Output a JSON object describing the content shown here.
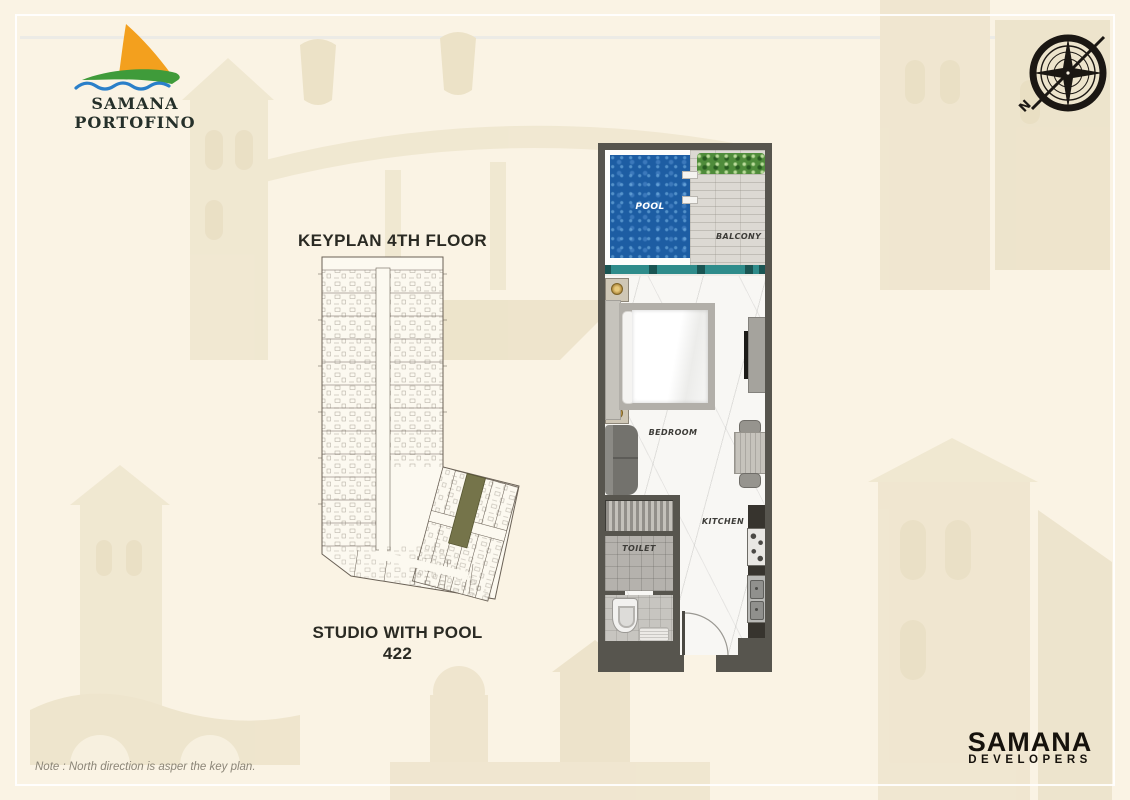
{
  "header": {
    "logo_title": "SAMANA PORTOFINO",
    "compass_north": "N"
  },
  "keyplan": {
    "title": "KEYPLAN 4TH FLOOR",
    "highlight_color": "#75744a"
  },
  "unit": {
    "name": "STUDIO WITH POOL",
    "number": "422"
  },
  "floorplan": {
    "labels": {
      "pool": "POOL",
      "balcony": "BALCONY",
      "bedroom": "BEDROOM",
      "kitchen": "KITCHEN",
      "toilet": "TOILET"
    },
    "colors": {
      "wall": "#57554e",
      "pool_water": "#1d5da3",
      "glass_balustrade": "#2f8c8b",
      "deck": "#dcd9d3",
      "hedge": "#4f8c3b",
      "marble_floor": "#f8f7f4"
    }
  },
  "footer": {
    "note": "Note : North direction is asper the key plan.",
    "developer_name": "SAMANA",
    "developer_subtitle": "DEVELOPERS"
  }
}
